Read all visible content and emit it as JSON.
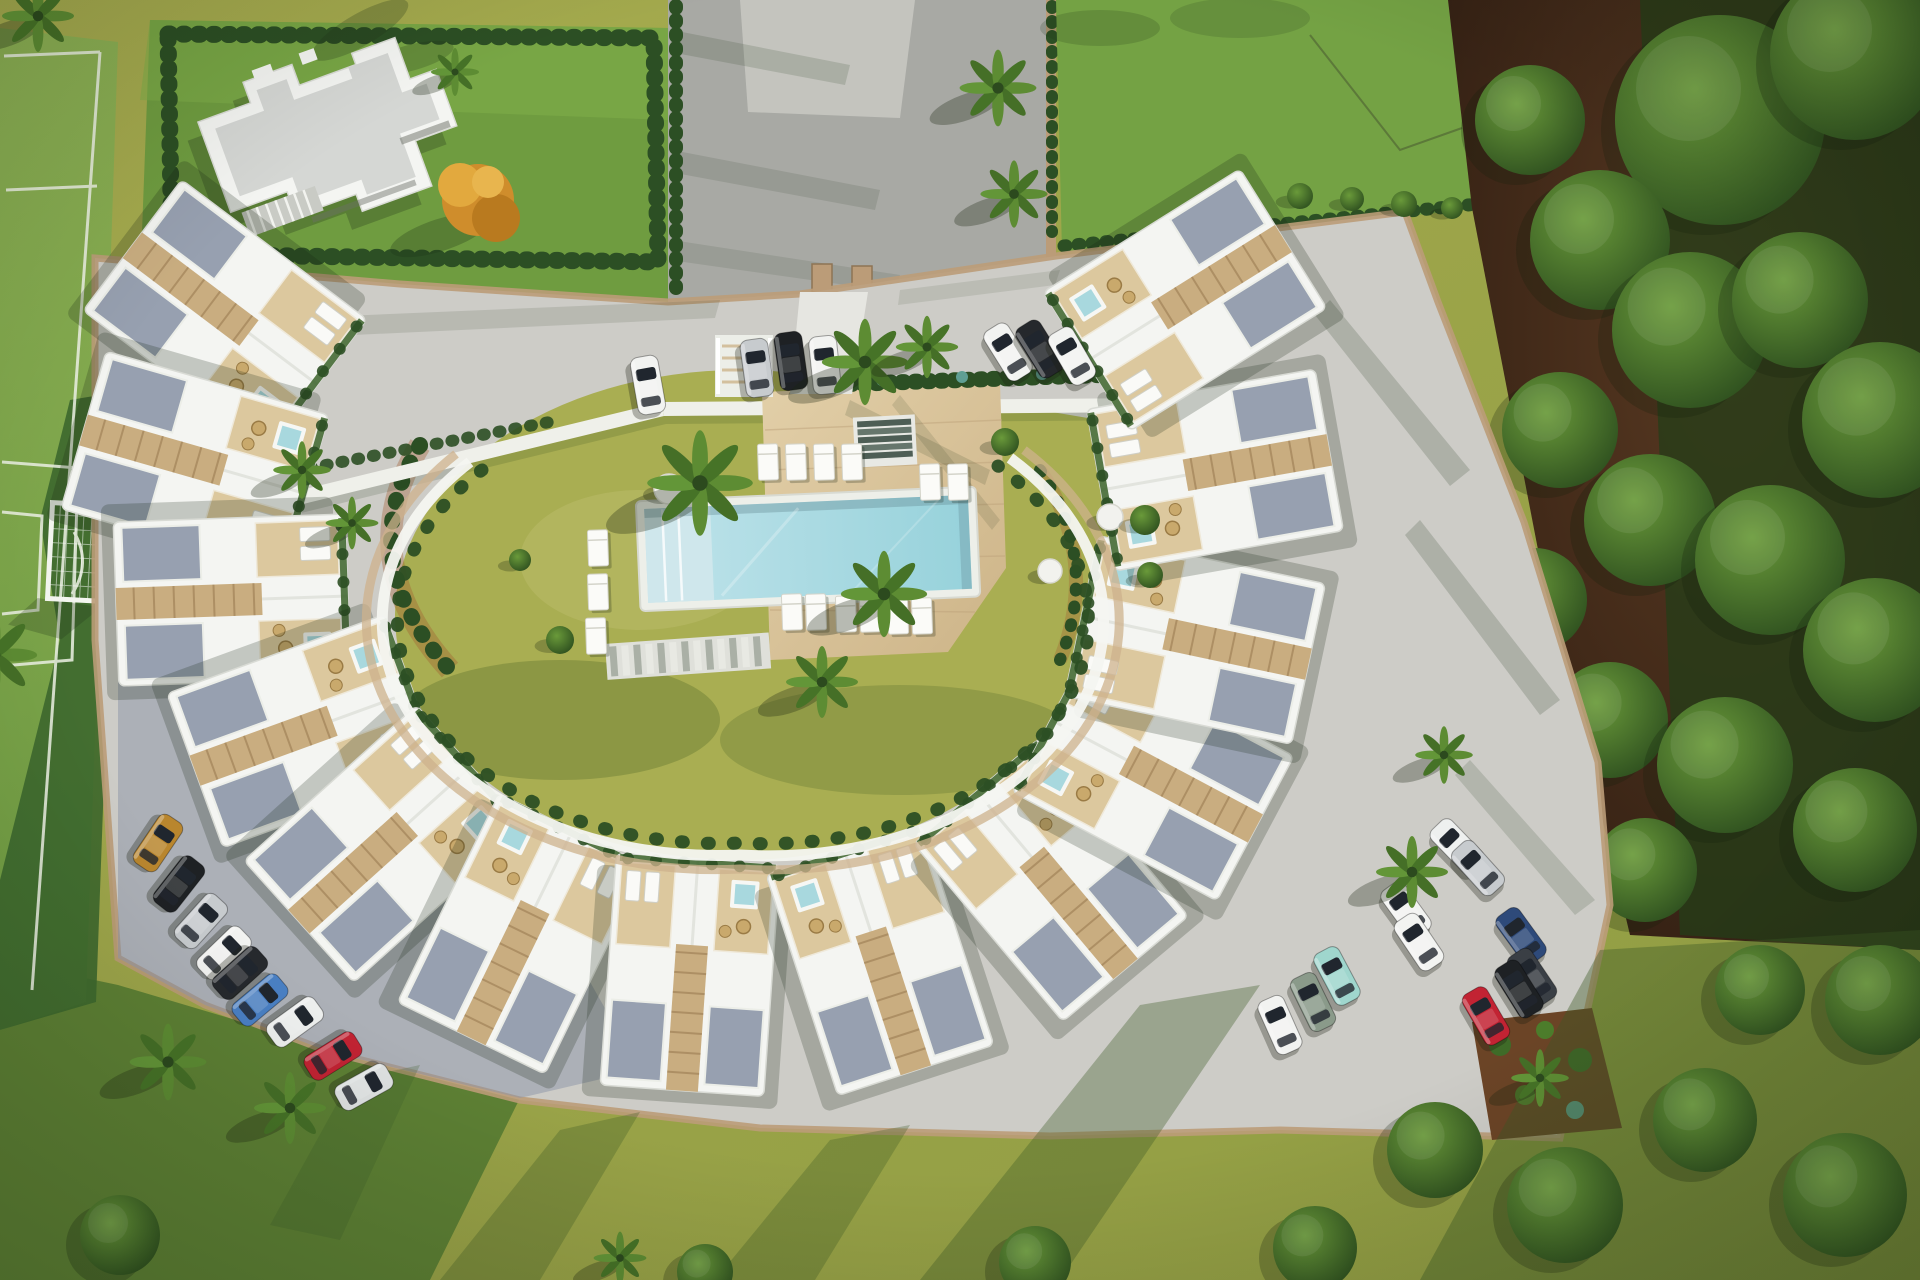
{
  "scene": {
    "kind": "aerial-architectural-render",
    "description": "Top-down 3D rendering of a crescent-shaped residential complex with rooftop terraces and jacuzzis around a central courtyard with swimming pool, surrounded by parking areas, a football pitch, a neighbouring villa plot and woodland",
    "view": "top-down aerial"
  },
  "palette": {
    "base_lawn": "#9ba447",
    "base_lawn_dark": "#7e9040",
    "field_green": "#85ab4e",
    "field_shadow": "#3d682e",
    "field_line": "#eef2e6",
    "plot_lawn": "#6f9c40",
    "hedge": "#2c4f24",
    "road": "#a8a9a4",
    "road_light": "#c6c7c1",
    "paving": "#cdccc7",
    "paving_shadow": "#8b93a7",
    "wall": "#bb9c78",
    "building": "#f4f5f2",
    "roof_gray": "#d5d7d4",
    "gravel": "#97a0b0",
    "wood": "#dcc89e",
    "wood_dark": "#c9ad80",
    "pool_coping": "#edefe9",
    "pool_water": "#a6dbe2",
    "pool_shallow": "#cfe7ec",
    "jacuzzi": "#a8d8de",
    "soil": "#4a3020",
    "forest_green": "#243d18",
    "courtyard": "#a9ae52",
    "courtyard_light": "#bcbc6a",
    "courtyard_shadow": "#6f7f36",
    "bed_edge": "#a05a2e",
    "white_band": "#eff0ea",
    "orange_tree": "#cf8d2c",
    "tree_mid": "#3f6b28",
    "teal_plant": "#5f9f93",
    "wicker": "#c9a96c"
  },
  "amenities": {
    "swimming_pool": 1,
    "rooftop_jacuzzis": 13,
    "sun_loungers": 15,
    "football_pitch": 1,
    "parking_areas": 3,
    "residential_blocks": 13
  },
  "counts": {
    "cars": 27,
    "palm_trees": 18,
    "forest_trees": 16,
    "lawn_trees": 10
  },
  "cars": [
    {
      "x": 648,
      "y": 385,
      "rot": -10,
      "c": "#f2f3f1",
      "n": "white"
    },
    {
      "x": 757,
      "y": 368,
      "rot": -8,
      "c": "#c7cbce",
      "n": "silver"
    },
    {
      "x": 791,
      "y": 361,
      "rot": -8,
      "c": "#1e2124",
      "n": "black"
    },
    {
      "x": 825,
      "y": 365,
      "rot": -6,
      "c": "#f2f3f1",
      "n": "white"
    },
    {
      "x": 1008,
      "y": 352,
      "rot": -32,
      "c": "#f2f3f1",
      "n": "white"
    },
    {
      "x": 1040,
      "y": 349,
      "rot": -32,
      "c": "#25282c",
      "n": "black"
    },
    {
      "x": 1072,
      "y": 356,
      "rot": -30,
      "c": "#f2f3f1",
      "n": "white"
    },
    {
      "x": 158,
      "y": 843,
      "rot": 34,
      "c": "#b9862e",
      "n": "gold"
    },
    {
      "x": 179,
      "y": 884,
      "rot": 38,
      "c": "#1e2124",
      "n": "black"
    },
    {
      "x": 201,
      "y": 921,
      "rot": 42,
      "c": "#c7cbce",
      "n": "silver"
    },
    {
      "x": 224,
      "y": 953,
      "rot": 46,
      "c": "#f2f3f1",
      "n": "white"
    },
    {
      "x": 240,
      "y": 973,
      "rot": 48,
      "c": "#26292d",
      "n": "black"
    },
    {
      "x": 260,
      "y": 1000,
      "rot": 50,
      "c": "#4a80c4",
      "n": "blue"
    },
    {
      "x": 295,
      "y": 1022,
      "rot": 54,
      "c": "#eef0ef",
      "n": "white"
    },
    {
      "x": 333,
      "y": 1056,
      "rot": 58,
      "c": "#c22333",
      "n": "red"
    },
    {
      "x": 364,
      "y": 1087,
      "rot": 61,
      "c": "#dfe2e2",
      "n": "silver"
    },
    {
      "x": 1457,
      "y": 846,
      "rot": -44,
      "c": "#eef0ef",
      "n": "white"
    },
    {
      "x": 1478,
      "y": 868,
      "rot": -42,
      "c": "#c7cbce",
      "n": "silver"
    },
    {
      "x": 1406,
      "y": 910,
      "rot": -36,
      "c": "#f2f3f1",
      "n": "white"
    },
    {
      "x": 1419,
      "y": 942,
      "rot": -34,
      "c": "#f2f3f1",
      "n": "white"
    },
    {
      "x": 1521,
      "y": 936,
      "rot": -36,
      "c": "#2e4a7a",
      "n": "dark-blue"
    },
    {
      "x": 1532,
      "y": 977,
      "rot": -34,
      "c": "#3a3f45",
      "n": "dark-gray"
    },
    {
      "x": 1337,
      "y": 976,
      "rot": -28,
      "c": "#9fd6cd",
      "n": "teal"
    },
    {
      "x": 1313,
      "y": 1002,
      "rot": -26,
      "c": "#8a9a8a",
      "n": "green"
    },
    {
      "x": 1280,
      "y": 1025,
      "rot": -24,
      "c": "#f2f3f1",
      "n": "white"
    },
    {
      "x": 1519,
      "y": 989,
      "rot": -32,
      "c": "#1e2124",
      "n": "black"
    },
    {
      "x": 1486,
      "y": 1016,
      "rot": -30,
      "c": "#c22333",
      "n": "red"
    }
  ],
  "units": [
    {
      "x": 225,
      "y": 315,
      "rot": 127,
      "v": 0
    },
    {
      "x": 195,
      "y": 462,
      "rot": 106,
      "v": 1
    },
    {
      "x": 232,
      "y": 600,
      "rot": 88,
      "v": 0
    },
    {
      "x": 304,
      "y": 731,
      "rot": 70,
      "v": 1
    },
    {
      "x": 385,
      "y": 844,
      "rot": 48,
      "v": 0
    },
    {
      "x": 522,
      "y": 934,
      "rot": 26,
      "v": 1
    },
    {
      "x": 690,
      "y": 975,
      "rot": 4,
      "v": 0
    },
    {
      "x": 880,
      "y": 960,
      "rot": -18,
      "v": 1
    },
    {
      "x": 1051,
      "y": 880,
      "rot": -40,
      "v": 0
    },
    {
      "x": 1153,
      "y": 774,
      "rot": -62,
      "v": 1
    },
    {
      "x": 1195,
      "y": 640,
      "rot": -78,
      "v": 0
    },
    {
      "x": 1215,
      "y": 470,
      "rot": -100,
      "v": 1
    },
    {
      "x": 1185,
      "y": 300,
      "rot": -122,
      "v": 0
    }
  ],
  "palms": [
    {
      "x": 998,
      "y": 88,
      "s": 1.6
    },
    {
      "x": 1014,
      "y": 194,
      "s": 1.4
    },
    {
      "x": 865,
      "y": 362,
      "s": 1.8
    },
    {
      "x": 927,
      "y": 347,
      "s": 1.3
    },
    {
      "x": 700,
      "y": 483,
      "s": 2.2
    },
    {
      "x": 884,
      "y": 594,
      "s": 1.8
    },
    {
      "x": 822,
      "y": 682,
      "s": 1.5
    },
    {
      "x": 302,
      "y": 470,
      "s": 1.2
    },
    {
      "x": 352,
      "y": 523,
      "s": 1.1
    },
    {
      "x": 168,
      "y": 1062,
      "s": 1.6
    },
    {
      "x": 290,
      "y": 1108,
      "s": 1.5
    },
    {
      "x": 1412,
      "y": 872,
      "s": 1.5
    },
    {
      "x": 1444,
      "y": 755,
      "s": 1.2
    },
    {
      "x": -6,
      "y": 655,
      "s": 1.8
    },
    {
      "x": 38,
      "y": 16,
      "s": 1.5
    },
    {
      "x": 455,
      "y": 72,
      "s": 1.0
    },
    {
      "x": 1540,
      "y": 1078,
      "s": 1.2
    },
    {
      "x": 620,
      "y": 1258,
      "s": 1.1
    }
  ],
  "forest_trees": [
    {
      "x": 1720,
      "y": 120,
      "r": 105
    },
    {
      "x": 1855,
      "y": 55,
      "r": 85
    },
    {
      "x": 1600,
      "y": 240,
      "r": 70
    },
    {
      "x": 1530,
      "y": 120,
      "r": 55
    },
    {
      "x": 1690,
      "y": 330,
      "r": 78
    },
    {
      "x": 1800,
      "y": 300,
      "r": 68
    },
    {
      "x": 1560,
      "y": 430,
      "r": 58
    },
    {
      "x": 1880,
      "y": 420,
      "r": 78
    },
    {
      "x": 1650,
      "y": 520,
      "r": 66
    },
    {
      "x": 1770,
      "y": 560,
      "r": 75
    },
    {
      "x": 1535,
      "y": 600,
      "r": 52
    },
    {
      "x": 1875,
      "y": 650,
      "r": 72
    },
    {
      "x": 1610,
      "y": 720,
      "r": 58
    },
    {
      "x": 1725,
      "y": 765,
      "r": 68
    },
    {
      "x": 1855,
      "y": 830,
      "r": 62
    },
    {
      "x": 1645,
      "y": 870,
      "r": 52
    }
  ],
  "south_trees": [
    {
      "x": 1435,
      "y": 1150,
      "r": 48
    },
    {
      "x": 1565,
      "y": 1205,
      "r": 58
    },
    {
      "x": 1705,
      "y": 1120,
      "r": 52
    },
    {
      "x": 1845,
      "y": 1195,
      "r": 62
    },
    {
      "x": 1315,
      "y": 1248,
      "r": 42
    },
    {
      "x": 1035,
      "y": 1262,
      "r": 36
    },
    {
      "x": 705,
      "y": 1272,
      "r": 28
    },
    {
      "x": 120,
      "y": 1235,
      "r": 40
    },
    {
      "x": 1880,
      "y": 1000,
      "r": 55
    },
    {
      "x": 1760,
      "y": 990,
      "r": 45
    }
  ],
  "shrubs": [
    {
      "x": 1300,
      "y": 196,
      "r": 13
    },
    {
      "x": 1352,
      "y": 199,
      "r": 12
    },
    {
      "x": 1404,
      "y": 204,
      "r": 13
    },
    {
      "x": 1452,
      "y": 208,
      "r": 11
    },
    {
      "x": 1005,
      "y": 442,
      "r": 14
    },
    {
      "x": 1145,
      "y": 520,
      "r": 15
    },
    {
      "x": 1150,
      "y": 575,
      "r": 13
    },
    {
      "x": 560,
      "y": 640,
      "r": 14
    },
    {
      "x": 520,
      "y": 560,
      "r": 11
    }
  ],
  "loungers": [
    {
      "x": 768,
      "y": 462
    },
    {
      "x": 796,
      "y": 462
    },
    {
      "x": 824,
      "y": 462
    },
    {
      "x": 852,
      "y": 462
    },
    {
      "x": 930,
      "y": 482
    },
    {
      "x": 958,
      "y": 482
    },
    {
      "x": 792,
      "y": 612
    },
    {
      "x": 816,
      "y": 612
    },
    {
      "x": 846,
      "y": 614
    },
    {
      "x": 870,
      "y": 614
    },
    {
      "x": 898,
      "y": 616
    },
    {
      "x": 922,
      "y": 616
    },
    {
      "x": 598,
      "y": 548
    },
    {
      "x": 598,
      "y": 592
    },
    {
      "x": 596,
      "y": 636
    }
  ],
  "poufs": [
    {
      "x": 669,
      "y": 489,
      "r": 15
    },
    {
      "x": 1110,
      "y": 517,
      "r": 13
    },
    {
      "x": 1050,
      "y": 571,
      "r": 12
    }
  ]
}
